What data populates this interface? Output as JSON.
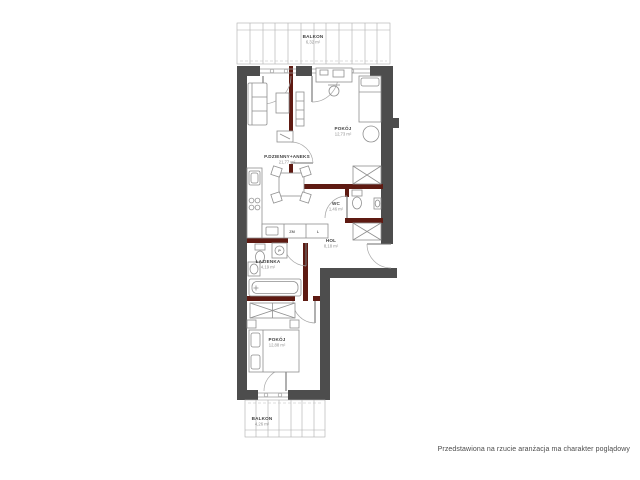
{
  "colors": {
    "wall": "#4d4d4d",
    "partition": "#5e1a12",
    "background": "#ffffff",
    "line": "#9b9b9b"
  },
  "rooms": [
    {
      "name": "BALKON",
      "area": "6,32 m²"
    },
    {
      "name": "POKÓJ",
      "area": "12,73 m²"
    },
    {
      "name": "P.DZIENNY+ANEKS",
      "area": "21,77 m²"
    },
    {
      "name": "WC",
      "area": "1,46 m²"
    },
    {
      "name": "HOL",
      "area": "8,18 m²"
    },
    {
      "name": "ŁAZIENKA",
      "area": "4,19 m²"
    },
    {
      "name": "POKÓJ",
      "area": "12,88 m²"
    },
    {
      "name": "BALKON",
      "area": "4,26 m²"
    }
  ],
  "appliances": {
    "dishwasher": "ZM",
    "fridge": "L",
    "washer": "P"
  },
  "footer": {
    "disclaimer": "Przedstawiona na rzucie aranżacja ma charakter poglądowy"
  }
}
